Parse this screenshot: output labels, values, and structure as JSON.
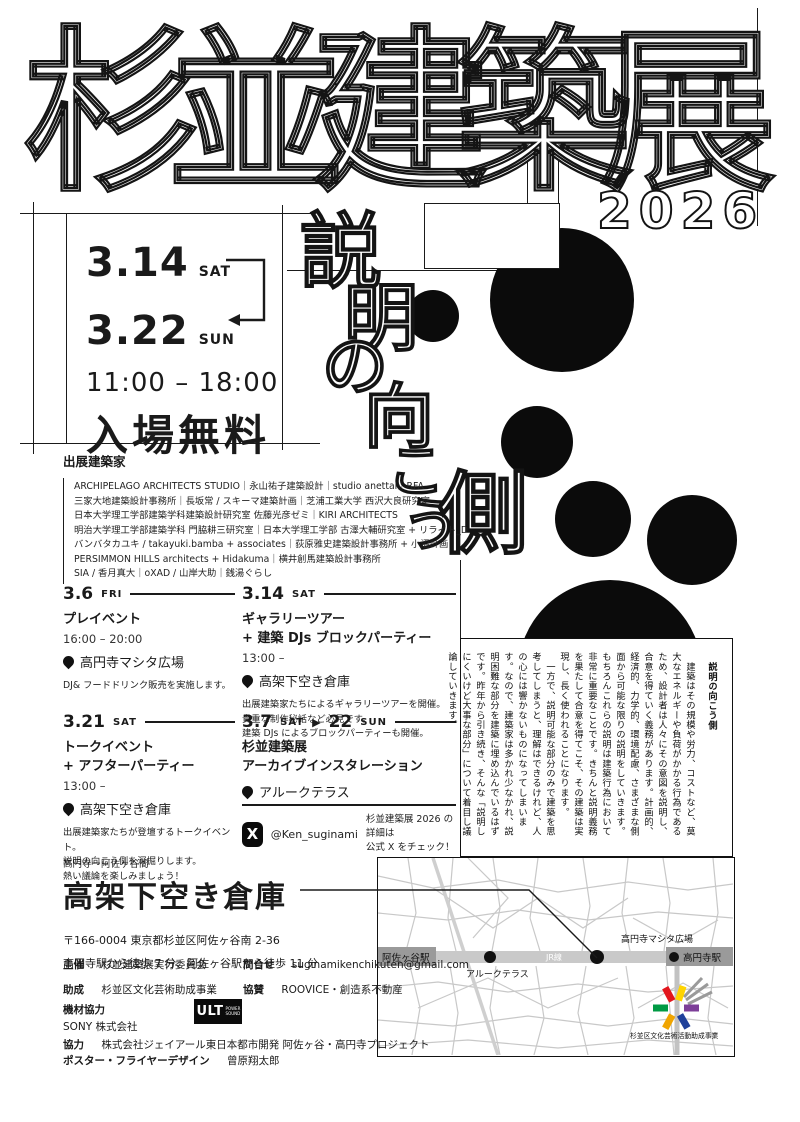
{
  "title": {
    "main": "杉並建築展",
    "year": "2026",
    "vertical_theme_chars": [
      "説",
      "明",
      "の",
      "向",
      "こ",
      "う",
      "側"
    ]
  },
  "dates": {
    "start_date": "3.14",
    "start_day": "SAT",
    "end_date": "3.22",
    "end_day": "SUN",
    "hours": "11:00 – 18:00",
    "admission": "入場無料"
  },
  "architects": {
    "heading": "出展建築家",
    "lines": [
      "ARCHIPELAGO ARCHITECTS STUDIO｜永山祐子建築設計｜studio anettai｜RFA",
      "三家大地建築設計事務所｜長坂常 / スキーマ建築計画｜芝浦工業大学 西沢大良研究室",
      "日本大学理工学部建築学科建築設計研究室 佐藤光彦ゼミ｜KIRI ARCHITECTS",
      "明治大学理工学部建築学科 門脇耕三研究室｜日本大学理工学部 古澤大輔研究室 + リライト_D",
      "バンバタカユキ / takayuki.bamba + associates｜荻原雅史建築設計事務所 + 小沼計画",
      "PERSIMMON HILLS architects + Hidakuma｜横井創馬建築設計事務所",
      "SIA / 香月真大｜oXAD / 山岸大助｜銭湯ぐらし"
    ]
  },
  "events": [
    {
      "date": "3.6",
      "day": "FRI",
      "title": [
        "プレイベント"
      ],
      "time": "16:00 – 20:00",
      "place": "高円寺マシタ広場",
      "desc": [
        "DJ& フードドリンク販売を実施します。"
      ]
    },
    {
      "date": "3.14",
      "day": "SAT",
      "title": [
        "ギャラリーツアー",
        "+ 建築 DJs ブロックパーティー"
      ],
      "time": "13:00 –",
      "place": "高架下空き倉庫",
      "desc": [
        "出展建築家たちによるギャラリーツアーを開催。",
        "貴重な制作秘話など必見です。",
        "建築 DJs によるブロックパーティーも開催。"
      ]
    },
    {
      "date": "3.21",
      "day": "SAT",
      "title": [
        "トークイベント",
        "+ アフターパーティー"
      ],
      "time": "13:00 –",
      "place": "高架下空き倉庫",
      "desc": [
        "出展建築家たちが登壇するトークイベント。",
        "説明の向こう側を深掘りします。",
        "熱い議論を楽しみましょう！"
      ]
    },
    {
      "date": "3.7",
      "day": "SAT",
      "range_separator": "▶",
      "date2": "22",
      "day2": "SUN",
      "title": [
        "杉並建築展",
        "アーカイブインスタレーション"
      ],
      "place": "アルークテラス"
    }
  ],
  "x_promo": {
    "icon": "X",
    "handle": "@Ken_suginami",
    "note_line1": "杉並建築展 2026 の詳細は",
    "note_line2": "公式 X をチェック！"
  },
  "essay": {
    "title": "説明の向こう側",
    "p1": "　建築はその規模や労力、コストなど、莫大なエネルギーや負荷がかかる行為であるため、設計者は人々にその意図を説明し、合意を得ていく義務があります。計画的、経済的、力学的、環境配慮、さまざまな側面から可能な限りの説明をしていきます。もちろんこれらの説明は建築行為において非常に重要なことです。きちんと説明義務を果たして合意を得てこそ、その建築は実現し、長く使われることになります。",
    "p2": "　一方で、説明可能な部分のみで建築を思考してしまうと、理解はできるけれど、人の心には響かないものになってしまいます。なので、建築家は多かれ少なかれ、説明困難な部分を建築に埋め込んでいるはずです。昨年から引き続き、そんな「説明しにくいけど大事な部分」について着目し議論していきます。"
  },
  "venue": {
    "area_note": "高円寺ー阿佐ヶ谷間",
    "name": "高架下空き倉庫",
    "postal": "〒166-0004 東京都杉並区阿佐ヶ谷南 2-36",
    "access": "高円寺駅から徒歩 7 分、阿佐ヶ谷駅から徒歩 11 分"
  },
  "credits": {
    "organizer_label": "主催",
    "organizer": "杉並建築展実行委員会",
    "contact_label": "問合せ",
    "contact": "suginamikenchikuten@gmail.com",
    "grant_label": "助成",
    "grant": "杉並区文化芸術助成事業",
    "sponsor_label": "協賛",
    "sponsor": "ROOVICE・創造系不動産",
    "equipment_label": "機材協力",
    "equipment": "SONY 株式会社",
    "equipment_logo_main": "ULT",
    "equipment_logo_sub": "POWER SOUND",
    "cooperation_label": "協力",
    "cooperation": "株式会社ジェイアール東日本都市開発 阿佐ヶ谷・高円寺プロジェクト",
    "design_label": "ポスター・フライヤーデザイン",
    "design": "曾原翔太郎"
  },
  "map": {
    "left_station": "阿佐ヶ谷駅",
    "right_station": "高円寺駅",
    "rail_line": "JR線",
    "terrace_label": "アルークテラス",
    "plaza_label": "高円寺マシタ広場",
    "logo_caption": "杉並区文化芸術活動助成事業",
    "colors": {
      "street": "#c8c8c8",
      "band": "#c9c9c9",
      "station_box": "#9a9a9a",
      "logo_red": "#e2161d",
      "logo_yellow": "#ffd400",
      "logo_green": "#009a44",
      "logo_purple": "#7d3f98",
      "logo_orange": "#f0a500",
      "logo_blue": "#1f419b"
    }
  }
}
